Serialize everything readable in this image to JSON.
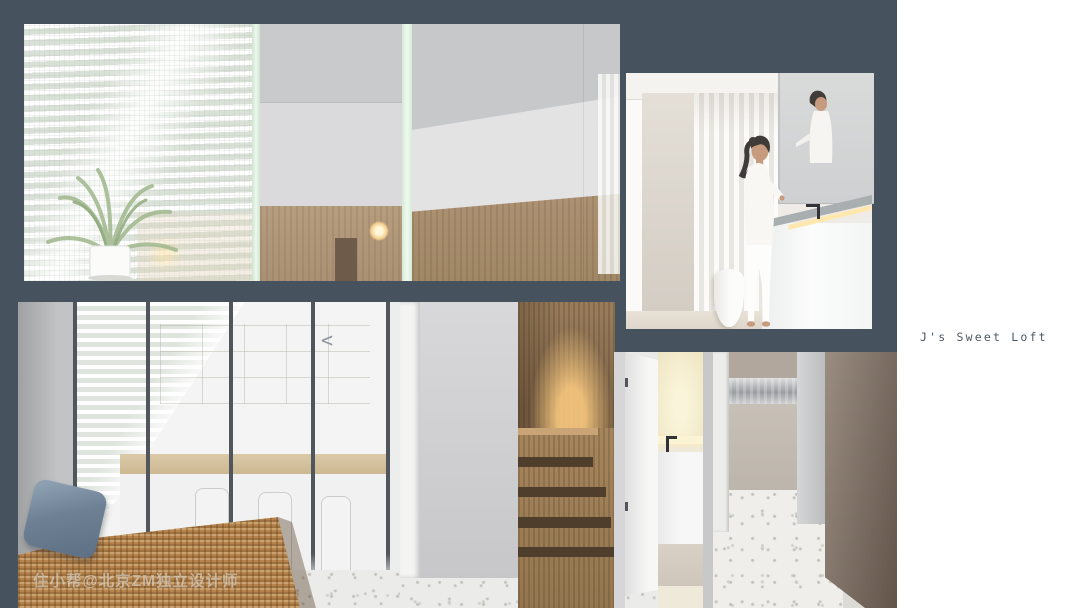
{
  "page": {
    "width": 1080,
    "height": 608,
    "background": "#ffffff"
  },
  "header": {
    "title": "J's Sweet Loft"
  },
  "watermark": {
    "text": "住小帮@北京ZM独立设计师"
  },
  "glyphs": {
    "glass_chevron": "<"
  },
  "colors": {
    "panel": "#46525e",
    "page_bg": "#ffffff",
    "title": "#4b5866",
    "rattan": "#b5834b",
    "pillow": "#6e8094",
    "terrazzo": "#ebebe9",
    "wood": "#977b5a",
    "wood_dark": "#4f3e2c",
    "glow": "#ffce82",
    "glass_tint": "#d4ead6",
    "taupe": "#7a6d62"
  },
  "renders": [
    {
      "name": "section-view",
      "description": "Sectional elevation: glass-brick wall with palm plant and blind shadows, bedroom with wood wainscot, wall lamp and upper stair volume"
    },
    {
      "name": "vanity-room",
      "description": "Woman in white at a white vanity with mirror cabinet, fluted wall, LED counter light and toilet"
    },
    {
      "name": "lounge",
      "description": "Rattan daybed with slate-blue cushion in front of a black-framed glass partition with shelving"
    },
    {
      "name": "staircase",
      "description": "Wood stair volume with warm concealed lighting on terrazzo floor"
    },
    {
      "name": "powder-room",
      "description": "Open white door revealing a lit basin niche"
    },
    {
      "name": "hallway",
      "description": "Entry hall with taupe walls, stainless-front cabinets and terrazzo floor"
    }
  ]
}
